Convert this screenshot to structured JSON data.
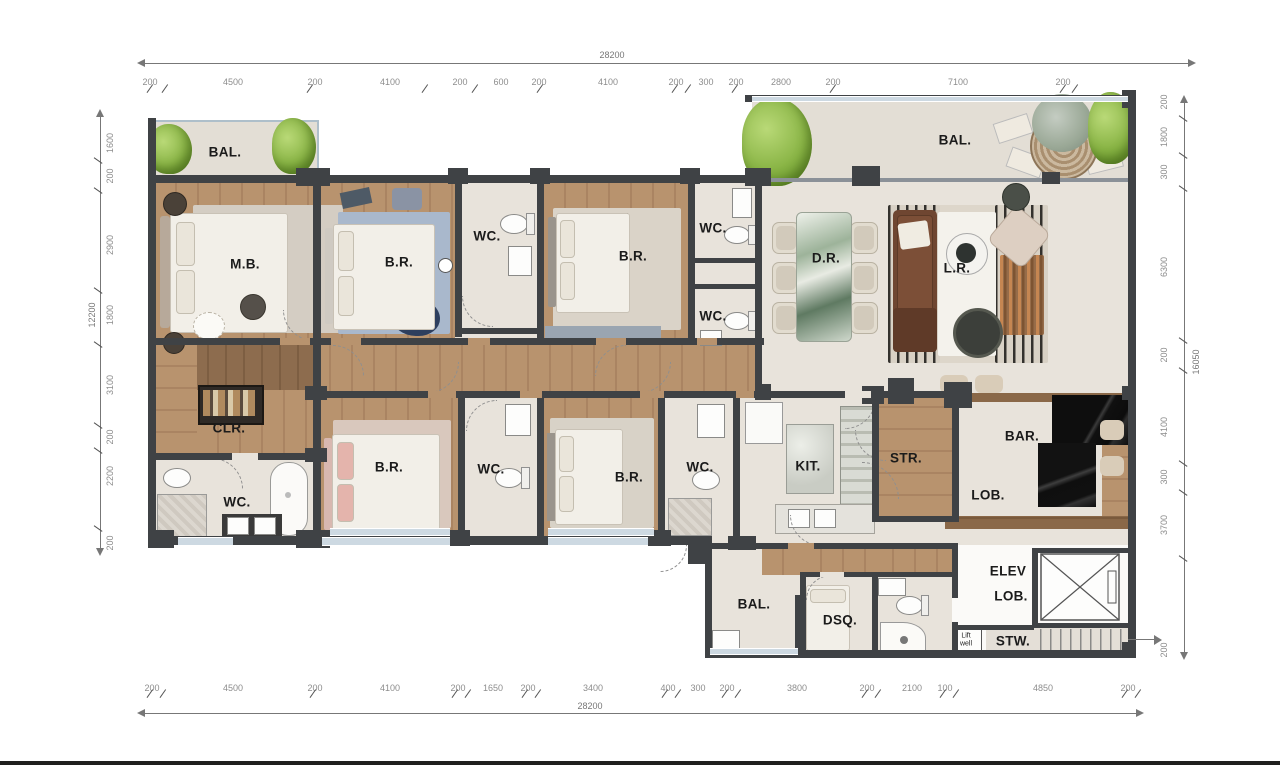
{
  "labels": {
    "bal": "BAL.",
    "mb": "M.B.",
    "br": "B.R.",
    "wc": "WC.",
    "dr": "D.R.",
    "lr": "L.R.",
    "clr": "CLR.",
    "kit": "KIT.",
    "str": "STR.",
    "bar": "BAR.",
    "lob": "LOB.",
    "elev_line1": "ELEV",
    "elev_line2": "LOB.",
    "stw": "STW.",
    "dsq": "DSQ.",
    "liftwell_line1": "Lift",
    "liftwell_line2": "well"
  },
  "dims": {
    "top": {
      "total": "28200",
      "segments": [
        "200",
        "4500",
        "200",
        "4100",
        "200",
        "600",
        "200",
        "4100",
        "200",
        "300",
        "200",
        "2800",
        "200",
        "7100",
        "200"
      ]
    },
    "bottom": {
      "total": "28200",
      "segments": [
        "200",
        "4500",
        "200",
        "4100",
        "200",
        "1650",
        "200",
        "3400",
        "400",
        "300",
        "200",
        "3800",
        "200",
        "2100",
        "100",
        "4850",
        "200"
      ]
    },
    "left": {
      "total": "12200",
      "segments": [
        "1600",
        "200",
        "2900",
        "1800",
        "3100",
        "200",
        "2200",
        "200"
      ]
    },
    "right": {
      "total": "16050",
      "segments": [
        "200",
        "1800",
        "300",
        "6300",
        "200",
        "4100",
        "300",
        "3700",
        "200"
      ]
    }
  },
  "colors": {
    "wall": "#3f4245",
    "wood_floor": "#b8936e",
    "stone_floor": "#e8e3db",
    "plant_green": "#8ab546",
    "bar_counter": "#141414",
    "sofa_brown": "#6f4631",
    "window": "#cdd9e2"
  }
}
